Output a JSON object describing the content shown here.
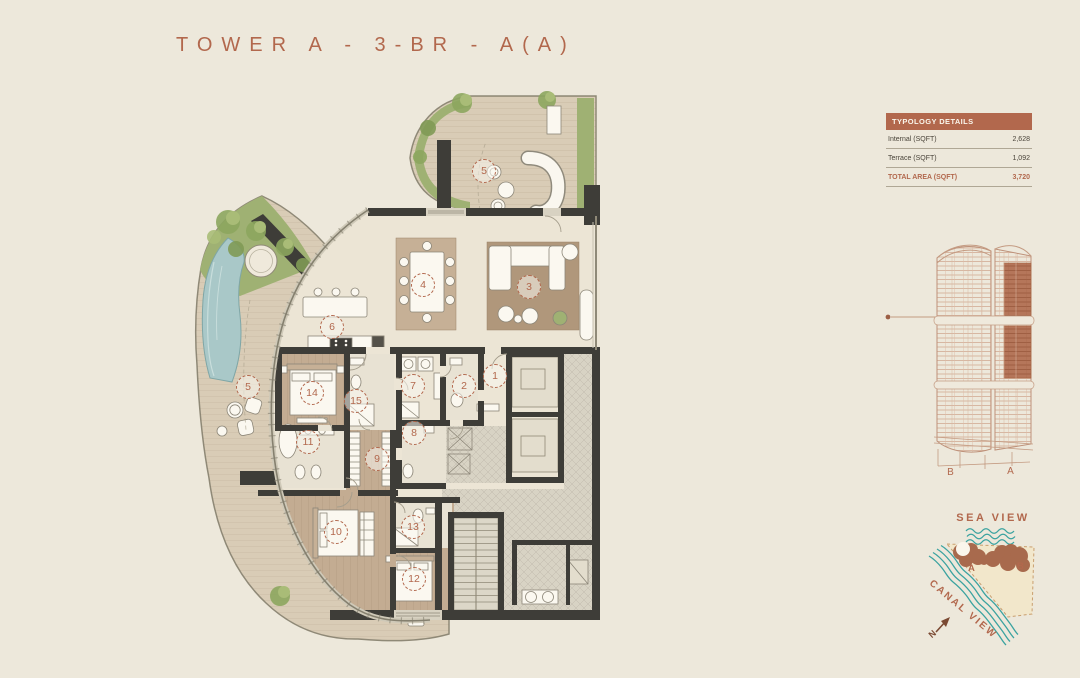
{
  "title": "TOWER A - 3-BR - A(A)",
  "typology": {
    "header": "TYPOLOGY DETAILS",
    "rows": [
      {
        "label": "Internal (SQFT)",
        "value": "2,628"
      },
      {
        "label": "Terrace (SQFT)",
        "value": "1,092"
      }
    ],
    "total_label": "TOTAL AREA (SQFT)",
    "total_value": "3,720"
  },
  "tower": {
    "left_label": "B",
    "right_label": "A"
  },
  "site": {
    "sea_label": "SEA VIEW",
    "canal_label": "CANAL VIEW",
    "north_label": "N",
    "building_a_label": "A",
    "building_b_label": "B"
  },
  "plan": {
    "markers": [
      {
        "n": "5",
        "x": 484,
        "y": 171
      },
      {
        "n": "3",
        "x": 529,
        "y": 287
      },
      {
        "n": "4",
        "x": 423,
        "y": 285
      },
      {
        "n": "6",
        "x": 332,
        "y": 327
      },
      {
        "n": "5",
        "x": 248,
        "y": 387
      },
      {
        "n": "14",
        "x": 312,
        "y": 393
      },
      {
        "n": "15",
        "x": 356,
        "y": 401
      },
      {
        "n": "7",
        "x": 413,
        "y": 386
      },
      {
        "n": "2",
        "x": 464,
        "y": 386
      },
      {
        "n": "1",
        "x": 495,
        "y": 376
      },
      {
        "n": "8",
        "x": 414,
        "y": 433
      },
      {
        "n": "11",
        "x": 308,
        "y": 442
      },
      {
        "n": "9",
        "x": 377,
        "y": 459
      },
      {
        "n": "10",
        "x": 336,
        "y": 532
      },
      {
        "n": "13",
        "x": 413,
        "y": 527
      },
      {
        "n": "12",
        "x": 414,
        "y": 579
      }
    ]
  },
  "colors": {
    "accent": "#B2684D",
    "bg": "#EDE8DB",
    "wall": "#3E3D38",
    "teal": "#3BA3A0",
    "green": "#9FB173",
    "pool": "#A9C8C8",
    "deck": "#D9CCB6",
    "wood": "#C3AC92",
    "site-brown": "#A86A4D",
    "north-brown": "#7B4A33"
  }
}
